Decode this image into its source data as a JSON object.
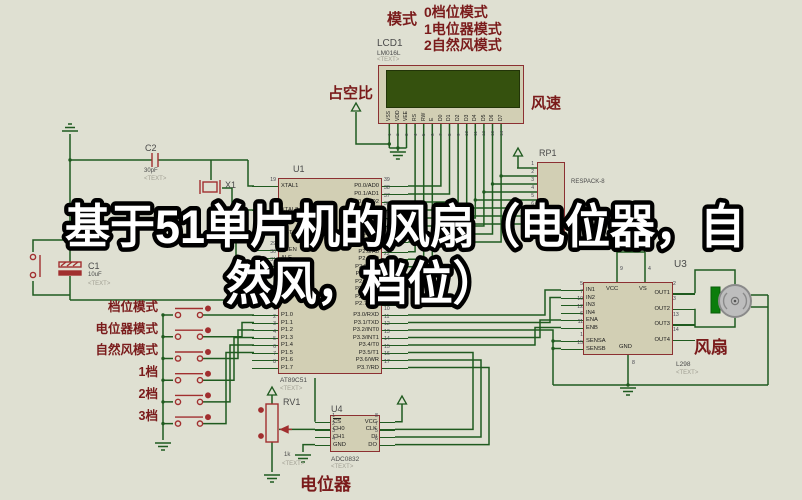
{
  "title_overlay": {
    "line1": "基于51单片机的风扇（电位器，自",
    "line2": "然风，档位）"
  },
  "mode_legend": {
    "heading": "模式",
    "items": [
      "0档位模式",
      "1电位器模式",
      "2自然风模式"
    ]
  },
  "lcd": {
    "ref": "LCD1",
    "part": "LM016L",
    "placeholder": "<TEXT>",
    "duty_label": "占空比",
    "speed_label": "风速",
    "pins": [
      {
        "num": "1",
        "label": "VSS"
      },
      {
        "num": "2",
        "label": "VDD"
      },
      {
        "num": "3",
        "label": "VEE"
      },
      {
        "num": "4",
        "label": "RS"
      },
      {
        "num": "5",
        "label": "RW"
      },
      {
        "num": "6",
        "label": "E"
      },
      {
        "num": "7",
        "label": "D0"
      },
      {
        "num": "8",
        "label": "D1"
      },
      {
        "num": "9",
        "label": "D2"
      },
      {
        "num": "10",
        "label": "D3"
      },
      {
        "num": "11",
        "label": "D4"
      },
      {
        "num": "12",
        "label": "D5"
      },
      {
        "num": "13",
        "label": "D6"
      },
      {
        "num": "14",
        "label": "D7"
      }
    ]
  },
  "rp1": {
    "ref": "RP1",
    "part": "RESPACK-8",
    "pins": [
      "1",
      "2",
      "3",
      "4",
      "5",
      "6",
      "7",
      "8"
    ]
  },
  "u1": {
    "ref": "U1",
    "part": "AT89C51",
    "placeholder": "<TEXT>",
    "xtal1": {
      "num": "19",
      "label": "XTAL1"
    },
    "xtal2": {
      "num": "18",
      "label": "XTAL2"
    },
    "rst": {
      "num": "9",
      "label": "RST"
    },
    "ctrl": [
      {
        "num": "29",
        "label": "PSEN"
      },
      {
        "num": "30",
        "label": "ALE"
      },
      {
        "num": "31",
        "label": "EA"
      }
    ],
    "pins_p1": [
      {
        "num": "1",
        "label": "P1.0"
      },
      {
        "num": "2",
        "label": "P1.1"
      },
      {
        "num": "3",
        "label": "P1.2"
      },
      {
        "num": "4",
        "label": "P1.3"
      },
      {
        "num": "5",
        "label": "P1.4"
      },
      {
        "num": "6",
        "label": "P1.5"
      },
      {
        "num": "7",
        "label": "P1.6"
      },
      {
        "num": "8",
        "label": "P1.7"
      }
    ],
    "pins_p0": [
      {
        "num": "39",
        "label": "P0.0/AD0"
      },
      {
        "num": "38",
        "label": "P0.1/AD1"
      },
      {
        "num": "37",
        "label": "P0.2/AD2"
      },
      {
        "num": "36",
        "label": "P0.3/AD3"
      },
      {
        "num": "35",
        "label": "P0.4/AD4"
      },
      {
        "num": "34",
        "label": "P0.5/AD5"
      },
      {
        "num": "33",
        "label": "P0.6/AD6"
      },
      {
        "num": "32",
        "label": "P0.7/AD7"
      }
    ],
    "pins_p2": [
      {
        "num": "21",
        "label": "P2.0/A8"
      },
      {
        "num": "22",
        "label": "P2.1/A9"
      },
      {
        "num": "23",
        "label": "P2.2/A10"
      },
      {
        "num": "24",
        "label": "P2.3/A11"
      },
      {
        "num": "25",
        "label": "P2.4/A12"
      },
      {
        "num": "26",
        "label": "P2.5/A13"
      },
      {
        "num": "27",
        "label": "P2.6/A14"
      },
      {
        "num": "28",
        "label": "P2.7/A15"
      }
    ],
    "pins_p3": [
      {
        "num": "10",
        "label": "P3.0/RXD"
      },
      {
        "num": "11",
        "label": "P3.1/TXD"
      },
      {
        "num": "12",
        "label": "P3.2/INT0"
      },
      {
        "num": "13",
        "label": "P3.3/INT1"
      },
      {
        "num": "14",
        "label": "P3.4/T0"
      },
      {
        "num": "15",
        "label": "P3.5/T1"
      },
      {
        "num": "16",
        "label": "P3.6/WR"
      },
      {
        "num": "17",
        "label": "P3.7/RD"
      }
    ]
  },
  "buttons": {
    "labels": [
      "档位模式",
      "电位器模式",
      "自然风模式",
      "1档",
      "2档",
      "3档"
    ]
  },
  "c2": {
    "ref": "C2",
    "value": "30pF",
    "placeholder": "<TEXT>"
  },
  "c1": {
    "ref": "C1",
    "value": "10uF",
    "placeholder": "<TEXT>"
  },
  "x1": {
    "ref": "X1"
  },
  "rv1": {
    "ref": "RV1",
    "value": "1k",
    "placeholder": "<TEXT>",
    "label": "电位器"
  },
  "u4": {
    "ref": "U4",
    "part": "ADC0832",
    "placeholder": "<TEXT>",
    "pins_left": [
      {
        "num": "1",
        "label": "CS"
      },
      {
        "num": "2",
        "label": "CH0"
      },
      {
        "num": "3",
        "label": "CH1"
      },
      {
        "num": "4",
        "label": "GND"
      }
    ],
    "pins_right": [
      {
        "num": "8",
        "label": "VCC"
      },
      {
        "num": "7",
        "label": "CLK"
      },
      {
        "num": "5",
        "label": "DI"
      },
      {
        "num": "6",
        "label": "DO"
      }
    ]
  },
  "u2": {
    "part": "L298",
    "placeholder": "<TEXT>",
    "pins_left": [
      {
        "num": "5",
        "label": "IN1"
      },
      {
        "num": "7",
        "label": "IN2"
      },
      {
        "num": "10",
        "label": "IN3"
      },
      {
        "num": "12",
        "label": "IN4"
      },
      {
        "num": "6",
        "label": "ENA"
      },
      {
        "num": "11",
        "label": "ENB"
      }
    ],
    "pins_sens": [
      {
        "num": "1",
        "label": "SENSA"
      },
      {
        "num": "15",
        "label": "SENSB"
      }
    ],
    "pins_right": [
      {
        "num": "2",
        "label": "OUT1"
      },
      {
        "num": "3",
        "label": "OUT2"
      },
      {
        "num": "13",
        "label": "OUT3"
      },
      {
        "num": "14",
        "label": "OUT4"
      }
    ],
    "pins_top": [
      {
        "num": "9",
        "label": "VCC"
      },
      {
        "num": "4",
        "label": "VS"
      }
    ],
    "pin_bottom": {
      "num": "8",
      "label": "GND"
    }
  },
  "u3": {
    "ref": "U3",
    "label": "风扇"
  }
}
